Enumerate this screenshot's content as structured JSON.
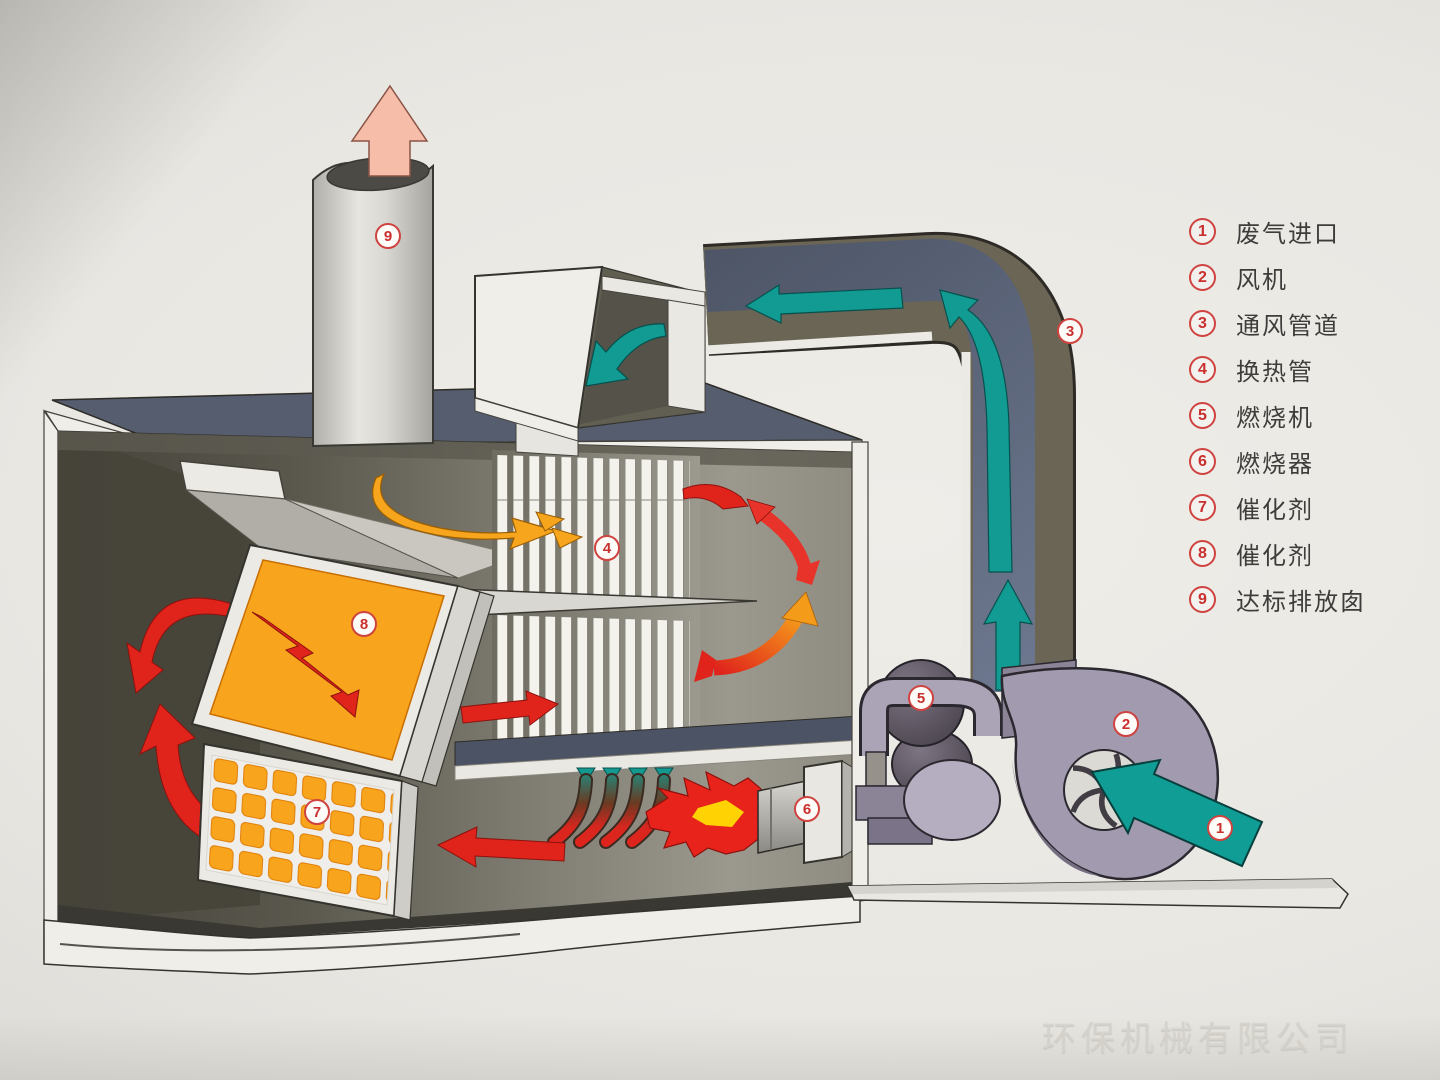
{
  "title": "催化燃烧废气处理系统示意图",
  "legend": {
    "items": [
      {
        "num": "1",
        "label": "废气进口"
      },
      {
        "num": "2",
        "label": "风机"
      },
      {
        "num": "3",
        "label": "通风管道"
      },
      {
        "num": "4",
        "label": "换热管"
      },
      {
        "num": "5",
        "label": "燃烧机"
      },
      {
        "num": "6",
        "label": "燃烧器"
      },
      {
        "num": "7",
        "label": "催化剂"
      },
      {
        "num": "8",
        "label": "催化剂"
      },
      {
        "num": "9",
        "label": "达标排放囱"
      }
    ]
  },
  "callouts": [
    {
      "num": "1"
    },
    {
      "num": "2"
    },
    {
      "num": "3"
    },
    {
      "num": "4"
    },
    {
      "num": "5"
    },
    {
      "num": "6"
    },
    {
      "num": "7"
    },
    {
      "num": "8"
    },
    {
      "num": "9"
    }
  ],
  "watermark": {
    "text": "环保机械有限公司"
  },
  "colors": {
    "badge_red": "#cf4340",
    "flow_teal": "#119b93",
    "flow_red": "#e0241c",
    "flow_orange": "#f6a51d",
    "catalyst_orange": "#f8a41d",
    "roof_slate": "#565d6e",
    "legend_text": "#3f3d3b",
    "paper": "#e9e7e2"
  }
}
